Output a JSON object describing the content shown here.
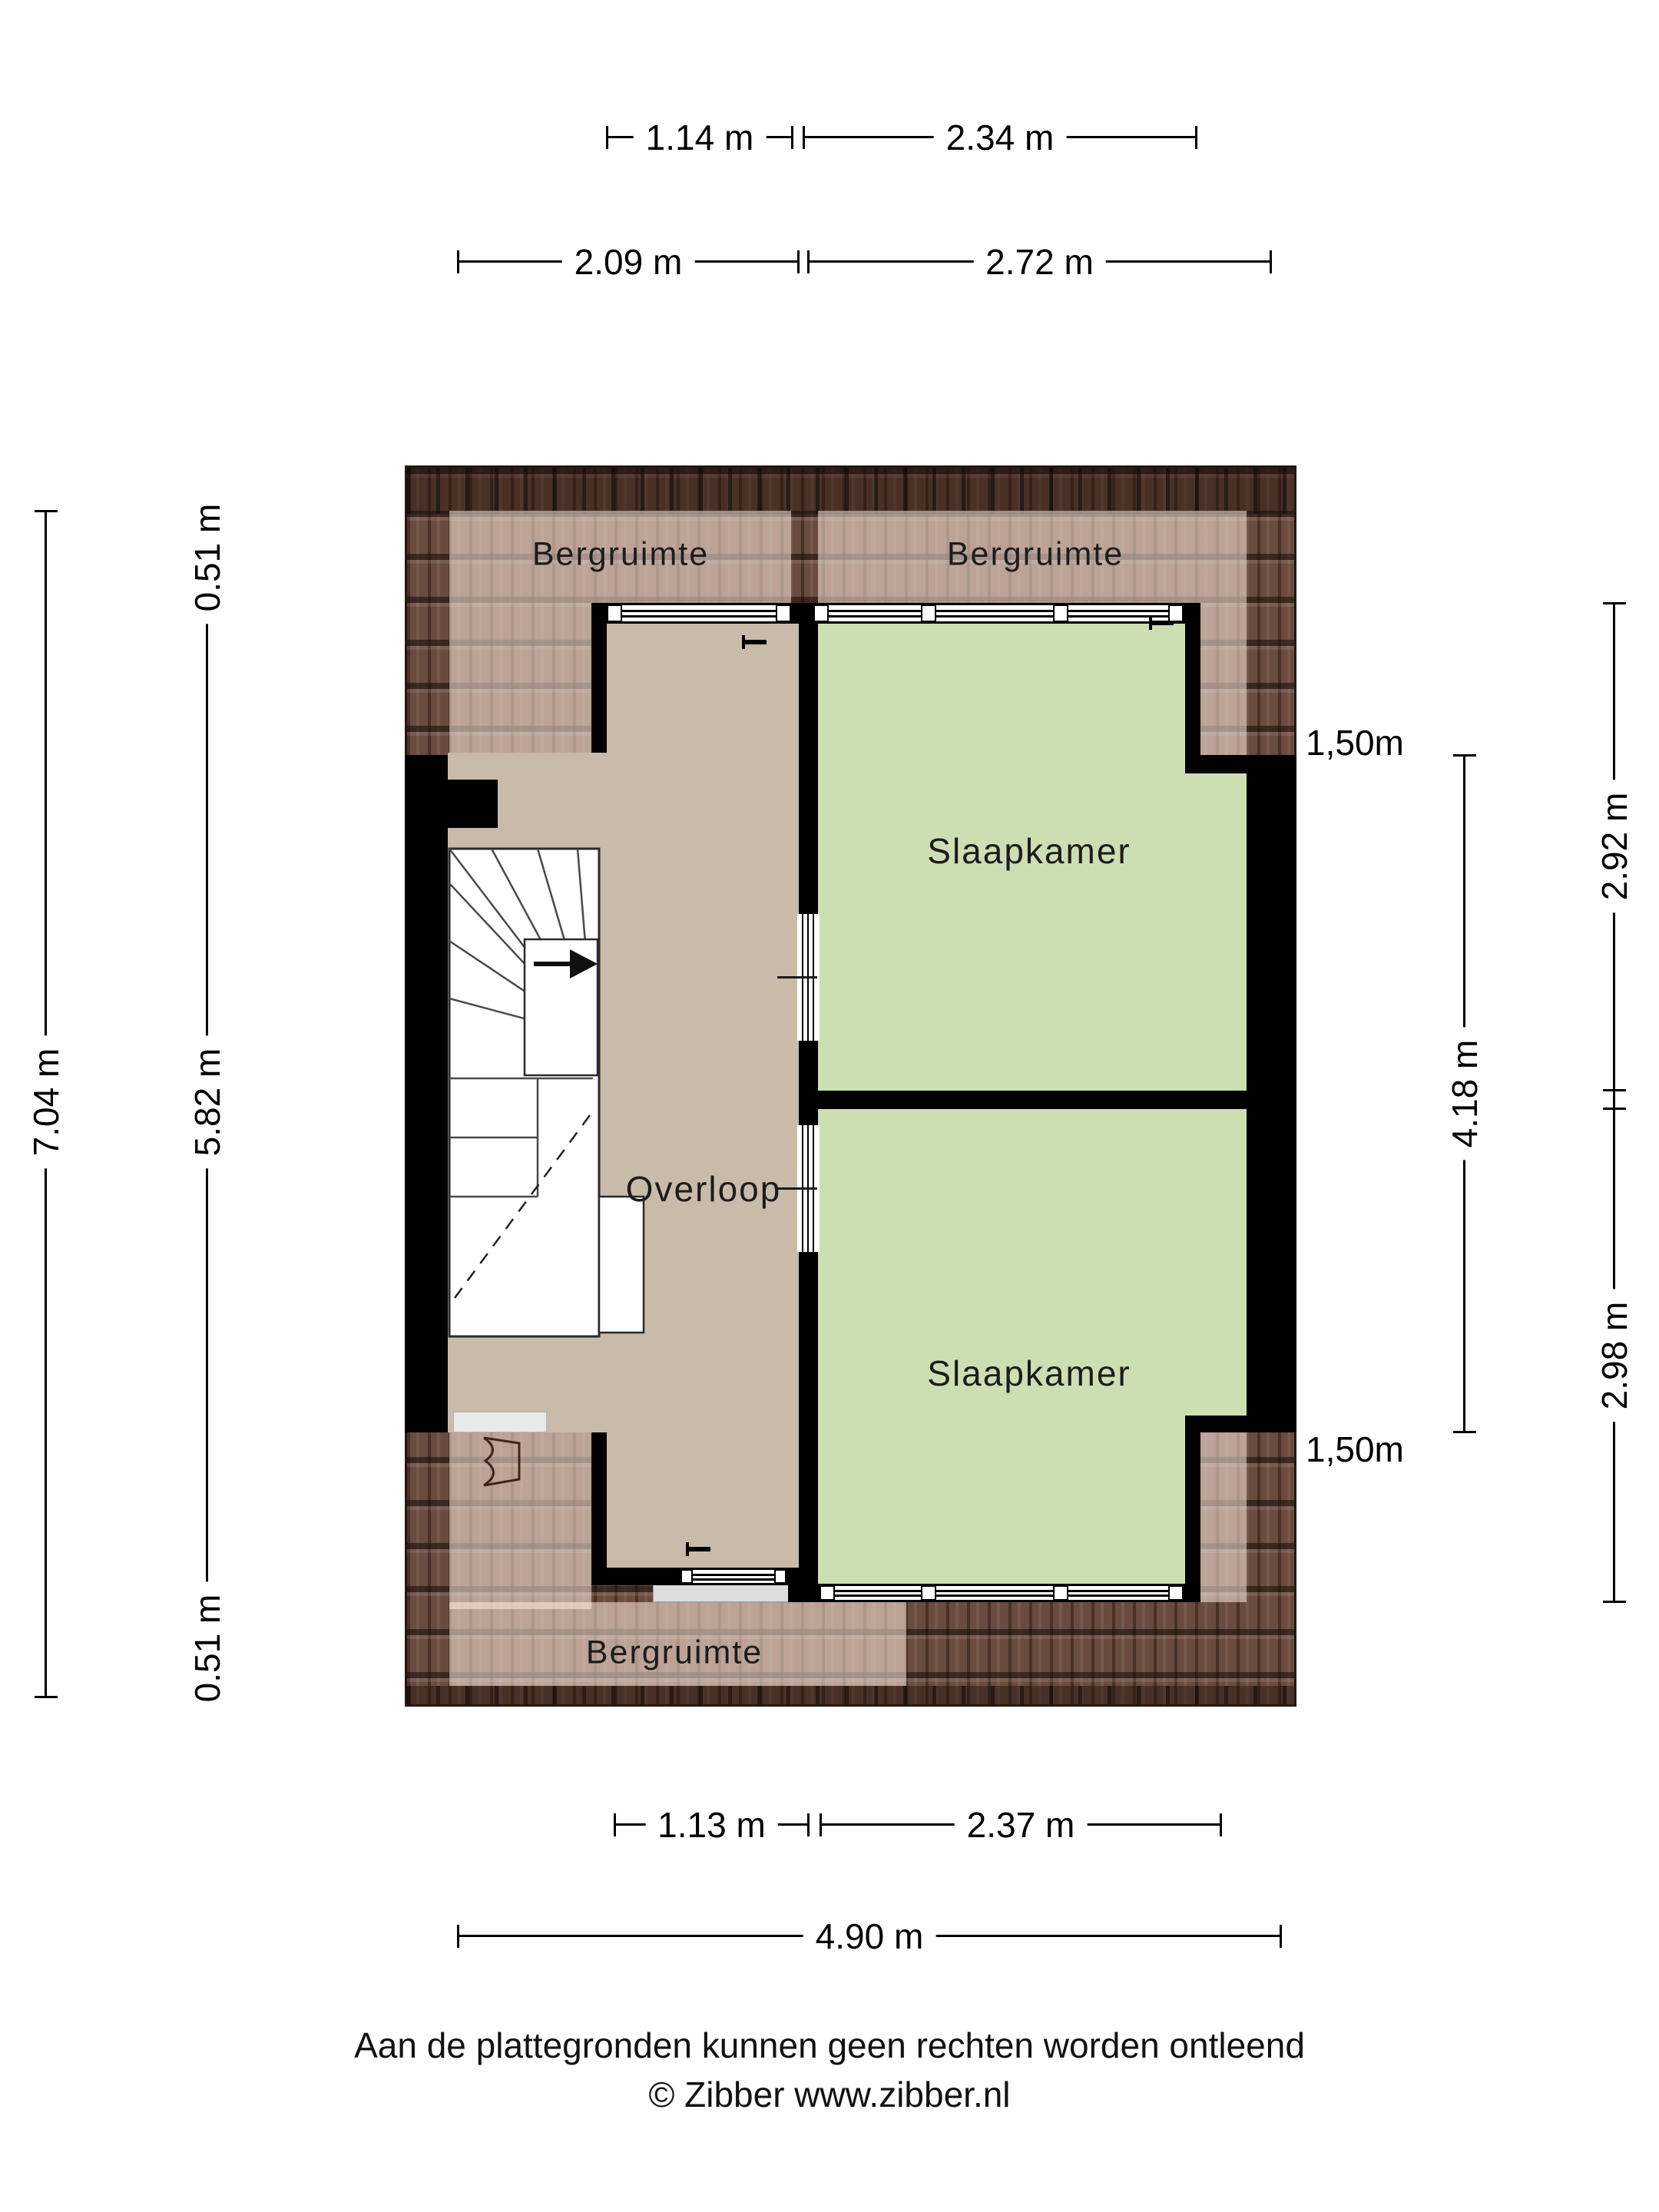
{
  "rooms": {
    "overloop": {
      "label": "Overloop"
    },
    "bedroom_top": {
      "label": "Slaapkamer"
    },
    "bedroom_bottom": {
      "label": "Slaapkamer"
    },
    "storage_top_left": {
      "label": "Bergruimte"
    },
    "storage_top_right": {
      "label": "Bergruimte"
    },
    "storage_bottom": {
      "label": "Bergruimte"
    }
  },
  "dimensions": {
    "top_row_inner": {
      "overloop_width": "1.14 m",
      "bedroom_width": "2.34 m"
    },
    "top_row_outer": {
      "left_width": "2.09 m",
      "right_width": "2.72 m"
    },
    "left_outer": {
      "total_height": "7.04 m"
    },
    "left_inner": {
      "eave_top": "0.51 m",
      "interior_height": "5.82 m",
      "eave_bottom": "0.51 m"
    },
    "right_knee": {
      "top": "1,50m",
      "bottom": "1,50m"
    },
    "right_inner": {
      "span": "4.18 m"
    },
    "right_outer": {
      "bedroom_top_height": "2.92 m",
      "bedroom_bottom_height": "2.98 m"
    },
    "bottom_row_inner": {
      "overloop_width": "1.13 m",
      "bedroom_width": "2.37 m"
    },
    "bottom_row_outer": {
      "total_width": "4.90 m"
    }
  },
  "footer": {
    "disclaimer": "Aan de plattegronden kunnen geen rechten worden ontleend",
    "copyright": "© Zibber www.zibber.nl"
  },
  "colors": {
    "roof_base": "#6a4b3f",
    "roof_overlay": "rgba(255,235,224,0.55)",
    "floor_overloop": "#c8bba9",
    "floor_bedroom": "#cbdfb3",
    "wall": "#000000",
    "sill": "#dddddd"
  }
}
